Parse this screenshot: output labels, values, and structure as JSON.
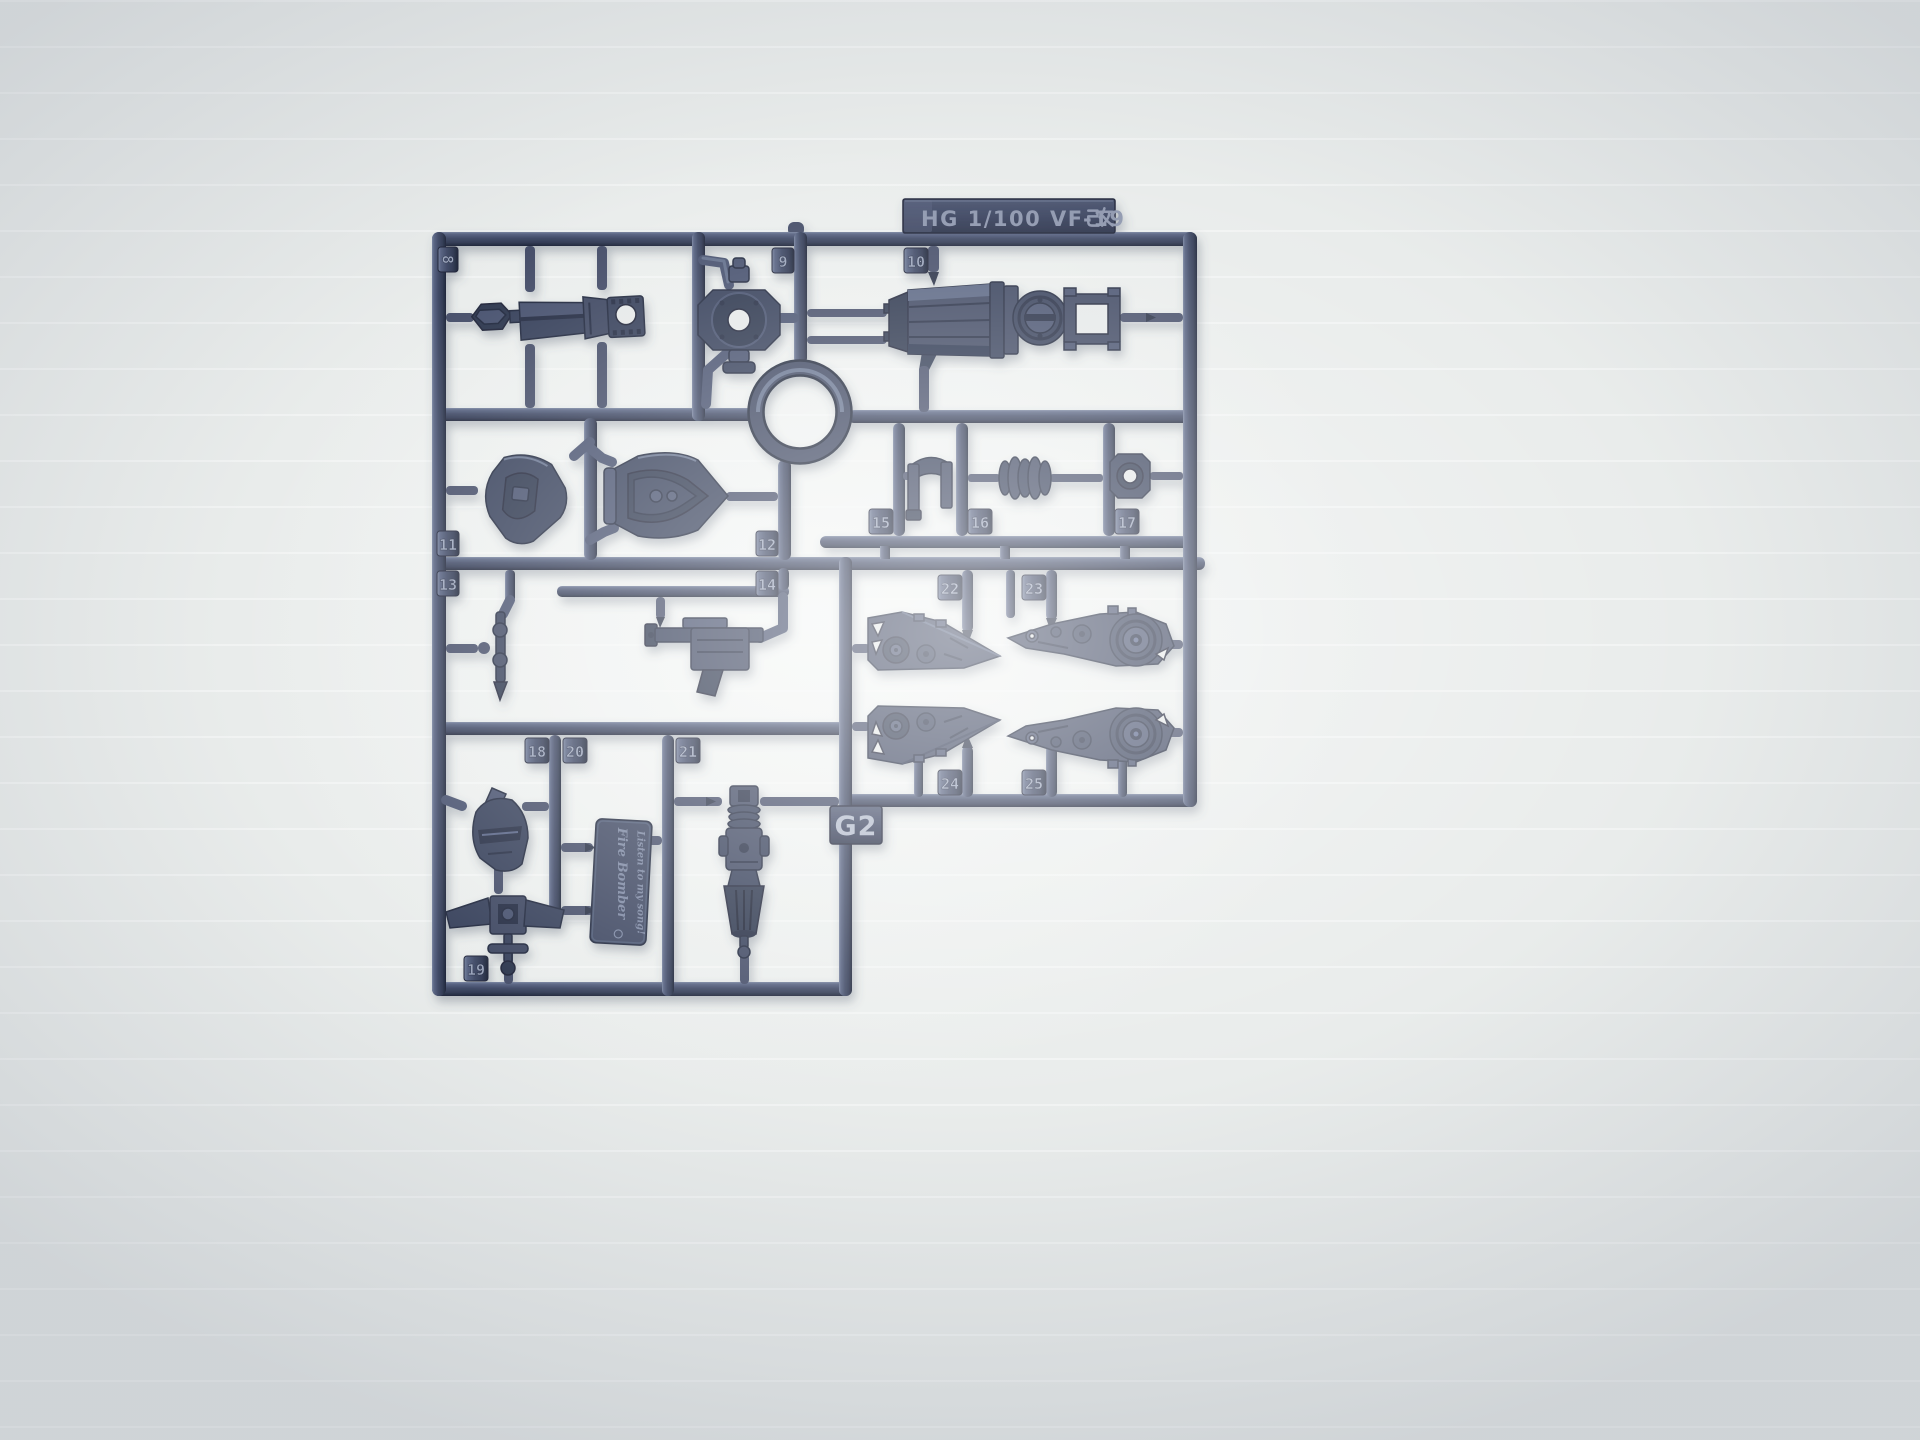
{
  "scene": {
    "subject": "Injection-molded plastic model kit runner (sprue) photographed on a white lightbox backdrop",
    "plastic_color": "#3e4860",
    "backdrop_color": "#e9eceb"
  },
  "sprue": {
    "title_plate": "HG 1/100 VF-19改",
    "title_plate_latin": "HG 1/100 VF-19",
    "title_plate_kanji": "改",
    "runner_code": "G2",
    "part_numbers": [
      "8",
      "9",
      "10",
      "11",
      "12",
      "13",
      "14",
      "15",
      "16",
      "17",
      "18",
      "19",
      "20",
      "21",
      "22",
      "23",
      "24",
      "25"
    ],
    "logo_plate": {
      "line1": "Fire Bomber",
      "line2": "Listen to my song!"
    }
  }
}
